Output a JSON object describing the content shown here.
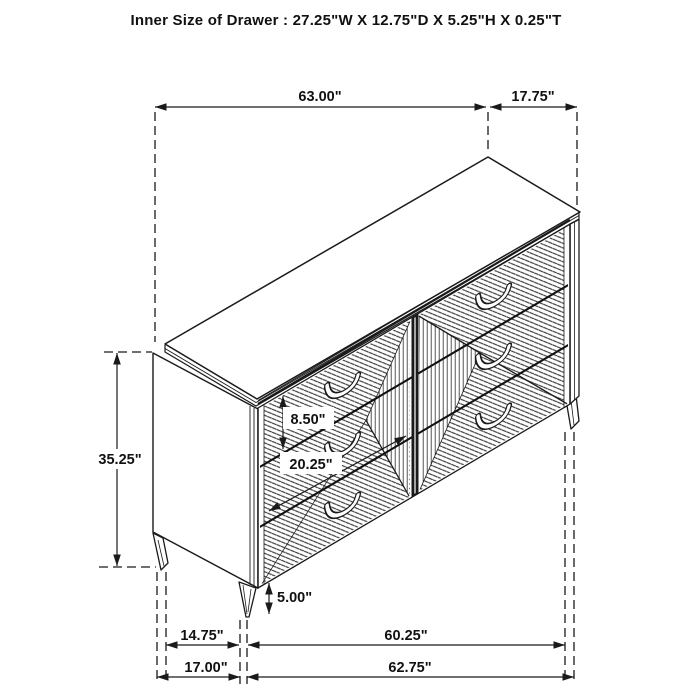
{
  "title": "Inner Size of Drawer : 27.25\"W X 12.75\"D X 5.25\"H X 0.25\"T",
  "diagram": {
    "subject": "6-drawer dresser isometric dimension drawing",
    "ink_color": "#1a1a1a",
    "background_color": "#ffffff",
    "drawer_count": 6
  },
  "dimensions": {
    "top_width": "63.00\"",
    "top_depth": "17.75\"",
    "overall_height": "35.25\"",
    "top_drawer_height": "8.50\"",
    "drawer_front_width": "20.25\"",
    "leg_height": "5.00\"",
    "bottom_depth_inner": "14.75\"",
    "bottom_width_inner": "60.25\"",
    "bottom_depth_outer": "17.00\"",
    "bottom_width_outer": "62.75\""
  }
}
